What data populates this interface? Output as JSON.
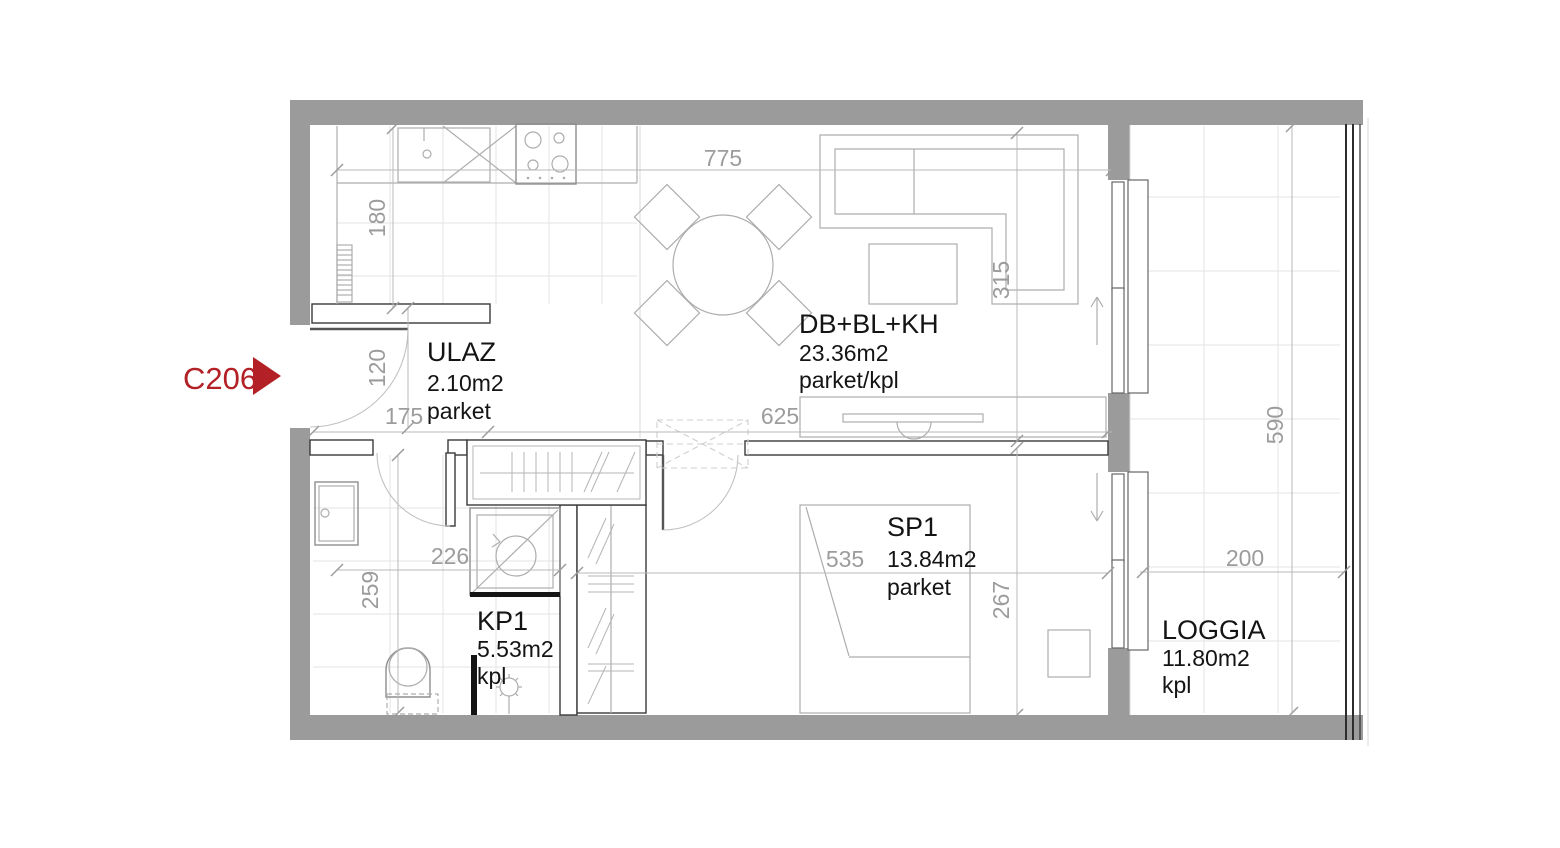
{
  "unit_marker": {
    "code": "C206"
  },
  "rooms": [
    {
      "key": "ulaz",
      "name": "ULAZ",
      "area": "2.10m2",
      "floor": "parket"
    },
    {
      "key": "living",
      "name": "DB+BL+KH",
      "area": "23.36m2",
      "floor": "parket/kpl"
    },
    {
      "key": "bathroom",
      "name": "KP1",
      "area": "5.53m2",
      "floor": "kpl"
    },
    {
      "key": "bedroom",
      "name": "SP1",
      "area": "13.84m2",
      "floor": "parket"
    },
    {
      "key": "loggia",
      "name": "LOGGIA",
      "area": "11.80m2",
      "floor": "kpl"
    }
  ],
  "dimensions": {
    "top_width": "775",
    "entry_width": "175",
    "living_bottom_width": "625",
    "kitchen_depth": "180",
    "entry_opening": "120",
    "bath_width": "226",
    "bath_depth": "259",
    "bedroom_width": "535",
    "bedroom_depth": "267",
    "living_depth": "315",
    "loggia_depth": "590",
    "loggia_width": "200"
  },
  "colors": {
    "accent": "#b32025",
    "wall": "#9b9b9b",
    "dim_text": "#9c9c9c",
    "outline": "#3a3a3a",
    "furniture_line": "#adadad",
    "grid_line": "#e3e3e3",
    "label_text": "#141414"
  }
}
